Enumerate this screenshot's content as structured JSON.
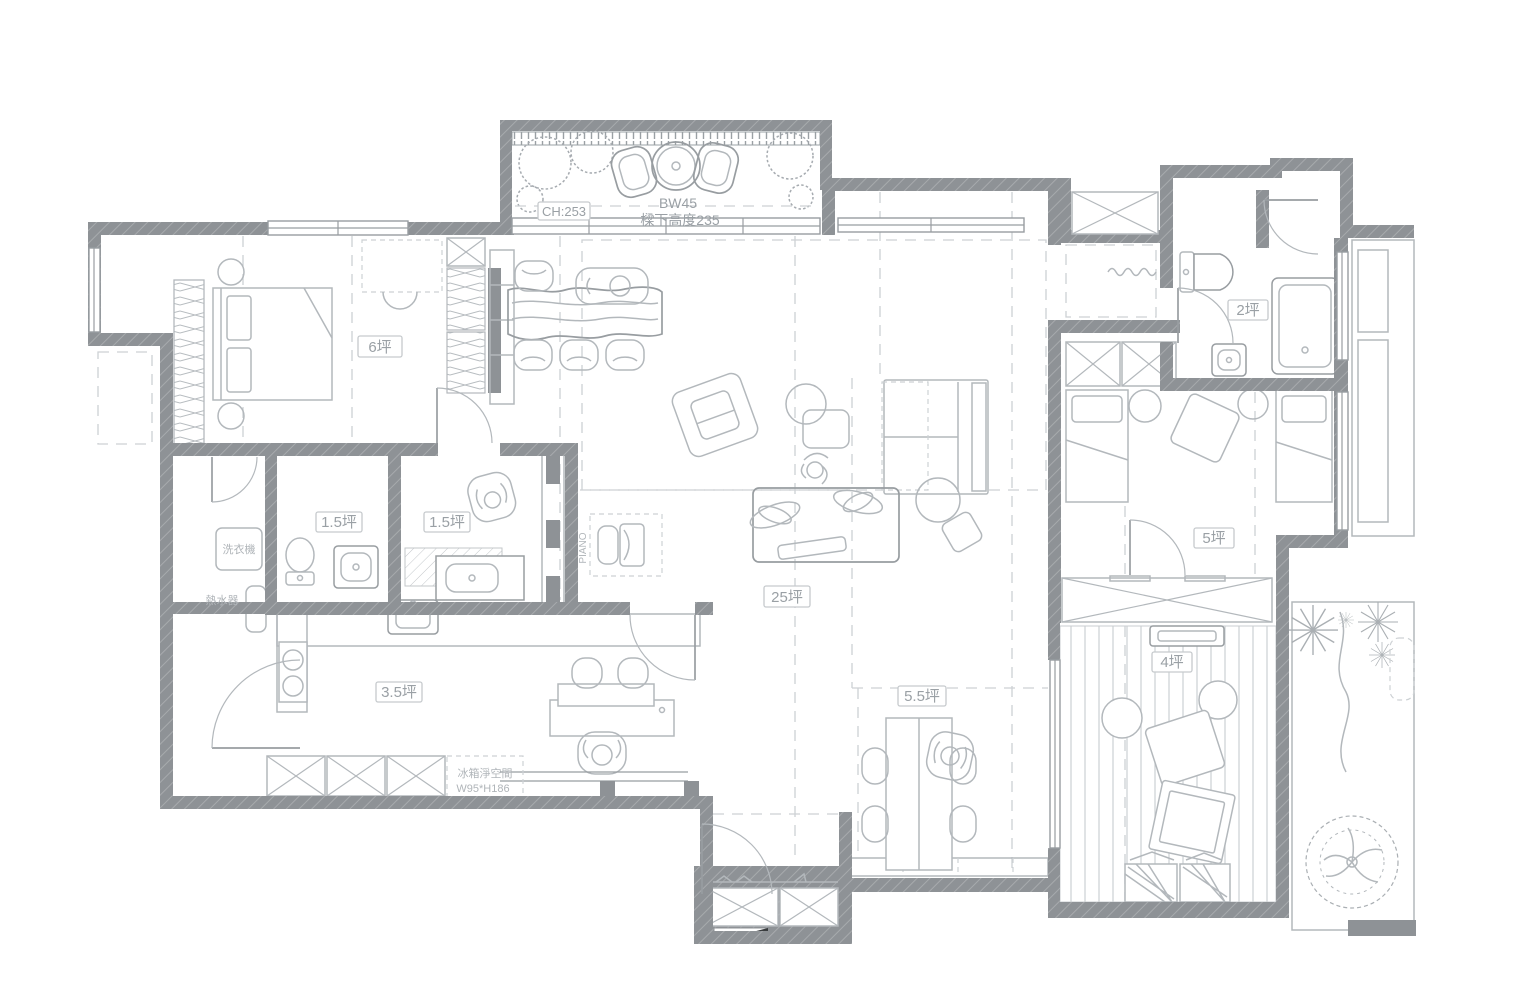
{
  "drawing": {
    "type": "apartment floor plan",
    "colors": {
      "wall": "#8e9296",
      "furn": "#b3b8bc",
      "furnD": "#989da1",
      "dash": "#cdd1d4",
      "lblT": "#9aa0a5",
      "lblB": "#c6cacd"
    },
    "labels": {
      "balcony_ceiling_height": "CH:253",
      "beam_code": "BW45",
      "beam_height_note": "樑下高度235",
      "master_bedroom_area": "6坪",
      "bathroom_top_right_area": "2坪",
      "bathroom_left_area": "1.5坪",
      "bathroom_mid_area": "1.5坪",
      "washing_machine": "洗衣機",
      "water_heater": "熱水器",
      "kitchen_area": "3.5坪",
      "living_area": "25坪",
      "dining_area": "5.5坪",
      "bedroom_right_area": "5坪",
      "tatami_room_area": "4坪",
      "piano": "PIANO",
      "fridge_clearance_line1": "冰箱淨空間",
      "fridge_clearance_line2": "W95*H186"
    }
  }
}
